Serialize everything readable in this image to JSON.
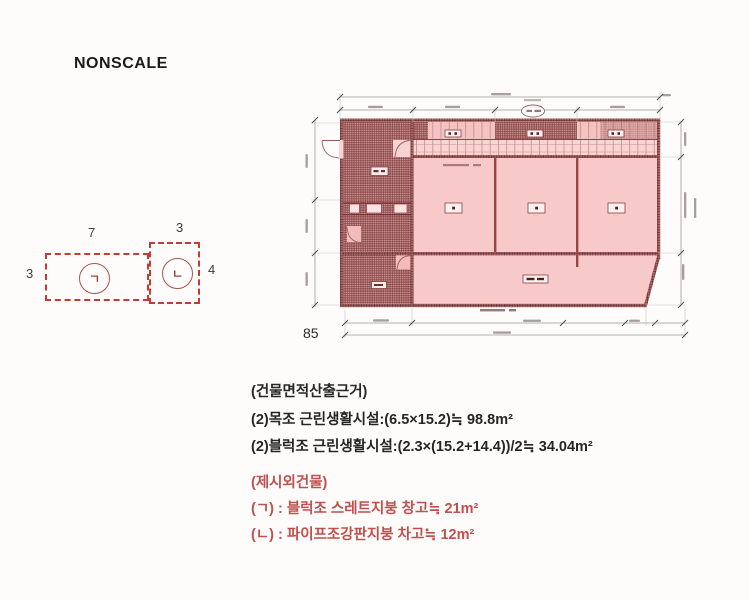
{
  "nonscale": "NONSCALE",
  "sketch": {
    "left_box": {
      "width_label": "7",
      "height_label": "3",
      "mark": "ㄱ"
    },
    "right_box": {
      "width_label": "3",
      "height_label": "4",
      "mark": "ㄴ"
    }
  },
  "plan": {
    "corner_label": "85"
  },
  "area_calc": {
    "title": "(건물면적산출근거)",
    "lines": [
      "(2)목조 근린생활시설:(6.5×15.2)≒ 98.8m²",
      "(2)블럭조 근린생활시설:(2.3×(15.2+14.4))/2≒ 34.04m²"
    ]
  },
  "extra_buildings": {
    "title": "(제시외건물)",
    "lines": [
      "(ㄱ) : 블럭조 스레트지붕 창고≒ 21m²",
      "(ㄴ) : 파이프조강판지붕 차고≒ 12m²"
    ]
  },
  "colors": {
    "red_text": "#c0504d",
    "sketch_red": "#c23c34",
    "plan_pink": "#f7c9c9",
    "plan_wall": "#8d3b3b"
  }
}
